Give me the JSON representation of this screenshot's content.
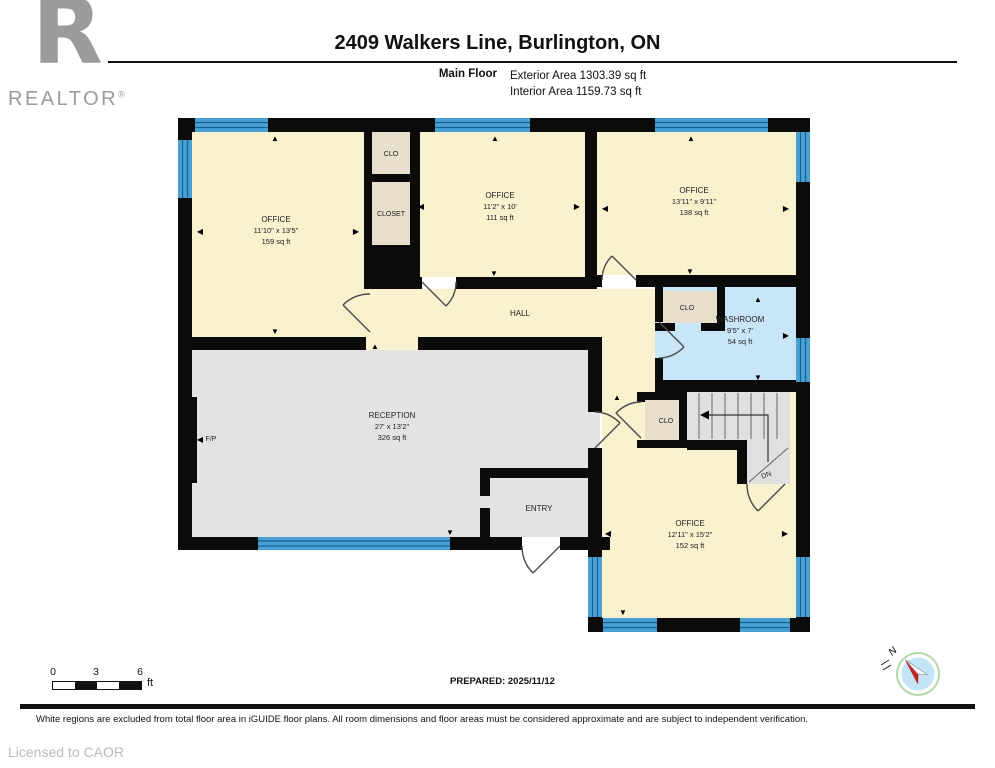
{
  "header": {
    "logo_r": "R",
    "logo_word": "REALTOR",
    "logo_reg": "®",
    "title": "2409 Walkers Line, Burlington, ON",
    "floor_label": "Main Floor",
    "exterior_area": "Exterior Area 1303.39 sq ft",
    "interior_area": "Interior Area 1159.73 sq ft"
  },
  "plan": {
    "rooms": [
      {
        "name": "OFFICE",
        "dims": "11'10\" x 13'5\"",
        "area": "159 sq ft"
      },
      {
        "name": "OFFICE",
        "dims": "11'2\" x 10'",
        "area": "111 sq ft"
      },
      {
        "name": "OFFICE",
        "dims": "13'11\" x 9'11\"",
        "area": "138 sq ft"
      },
      {
        "name": "WASHROOM",
        "dims": "9'5\" x 7'",
        "area": "54 sq ft"
      },
      {
        "name": "RECEPTION",
        "dims": "27' x 13'2\"",
        "area": "326 sq ft"
      },
      {
        "name": "OFFICE",
        "dims": "12'11\" x 15'2\"",
        "area": "152 sq ft"
      }
    ],
    "labels": {
      "hall": "HALL",
      "entry": "ENTRY",
      "clo_top": "CLO",
      "closet": "CLOSET",
      "clo_washroom": "CLO",
      "clo_stairs": "CLO",
      "down": "DN",
      "fireplace": "F/P"
    },
    "colors": {
      "room_cream": "#FAF1CE",
      "closet_beige": "#E7DFCB",
      "room_gray": "#E3E3E3",
      "washroom_blue": "#C8E6F8",
      "window_blue": "#49A0D5",
      "wall_black": "#0B0B0B"
    }
  },
  "scalebar": {
    "ticks": [
      "0",
      "3",
      "6"
    ],
    "unit": "ft"
  },
  "prepared": "PREPARED: 2025/11/12",
  "compass": {
    "north": "N"
  },
  "footer": {
    "disclaimer": "White regions are excluded from total floor area in iGUIDE floor plans. All room dimensions and floor areas must be considered approximate and are subject to independent verification.",
    "licensed": "Licensed to CAOR"
  }
}
